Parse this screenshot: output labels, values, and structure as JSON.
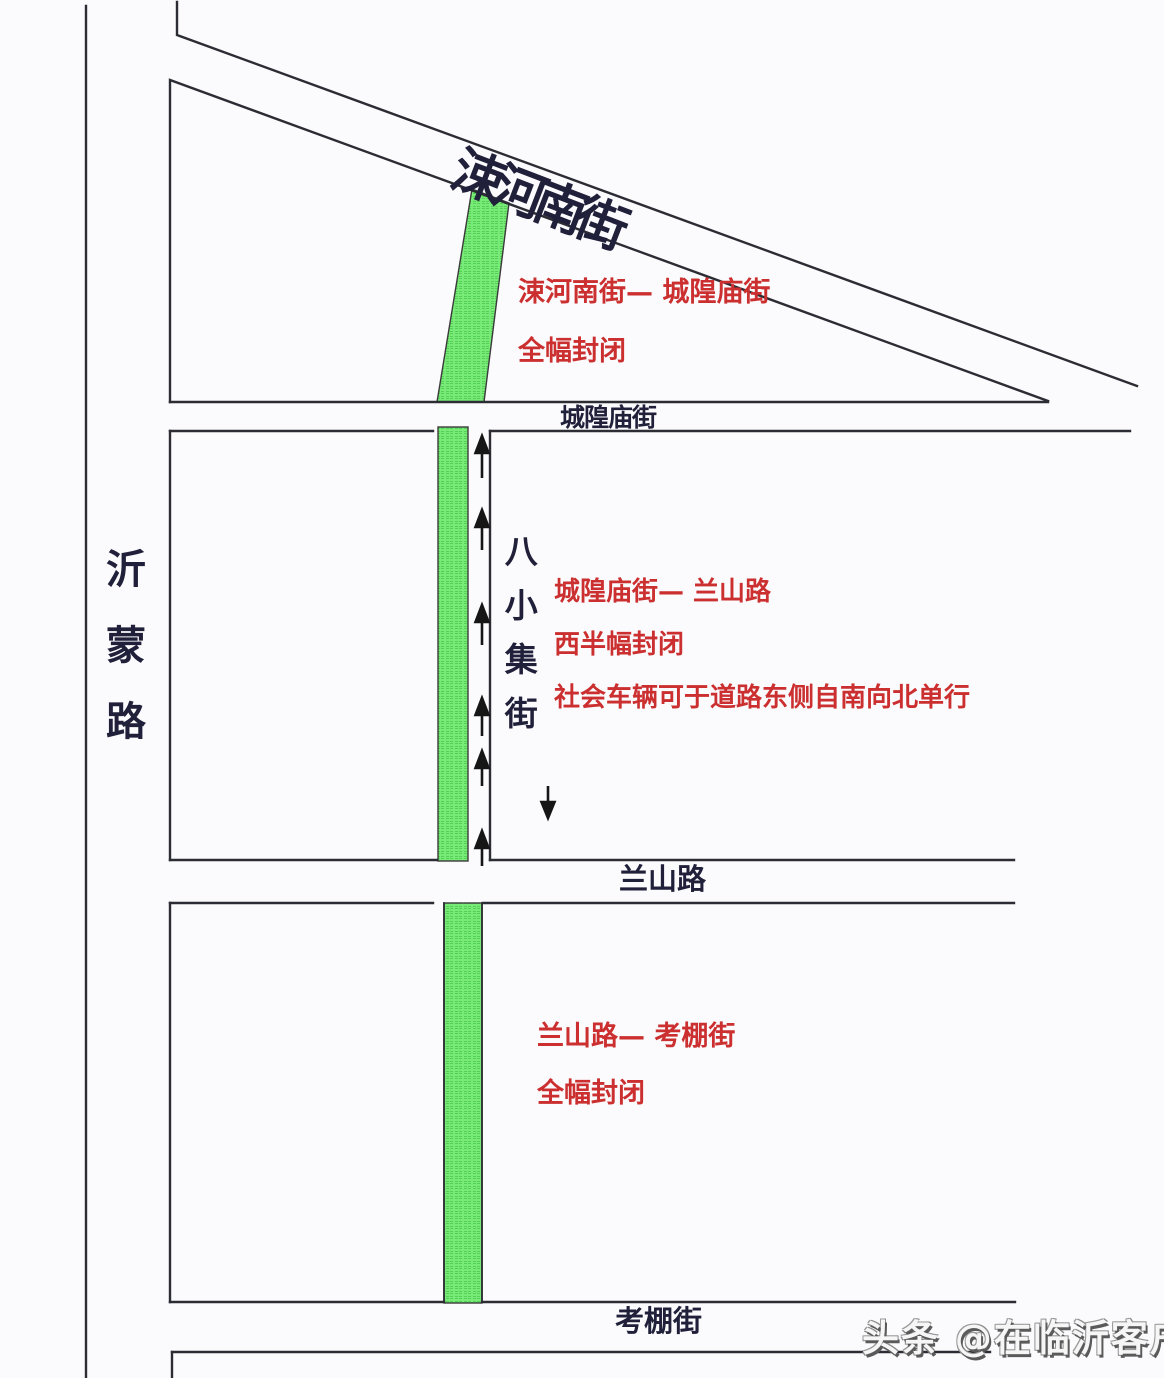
{
  "map": {
    "road_labels": {
      "yimeng_road": "沂蒙路",
      "suhe_south_street": "涑河南街",
      "chenghuangmiao_street": "城隍庙街",
      "baxiaoji_street": "八小集街",
      "lanshan_road": "兰山路",
      "kaopeng_street": "考棚街"
    },
    "closure_notes": {
      "north": {
        "line1": "涑河南街— 城隍庙街",
        "line2": "全幅封闭"
      },
      "middle": {
        "line1": "城隍庙街— 兰山路",
        "line2": "西半幅封闭",
        "line3": "社会车辆可于道路东侧自南向北单行"
      },
      "south": {
        "line1": "兰山路— 考棚街",
        "line2": "全幅封闭"
      }
    },
    "symbols": {
      "closed_section_fill": "#74e874",
      "note_red": "#cb2f2f",
      "road_line_color": "#2c2c34",
      "northbound_arrow_count": 6,
      "southbound_arrow_count": 1
    }
  },
  "watermark": {
    "text": "头条 @在临沂客户端"
  }
}
